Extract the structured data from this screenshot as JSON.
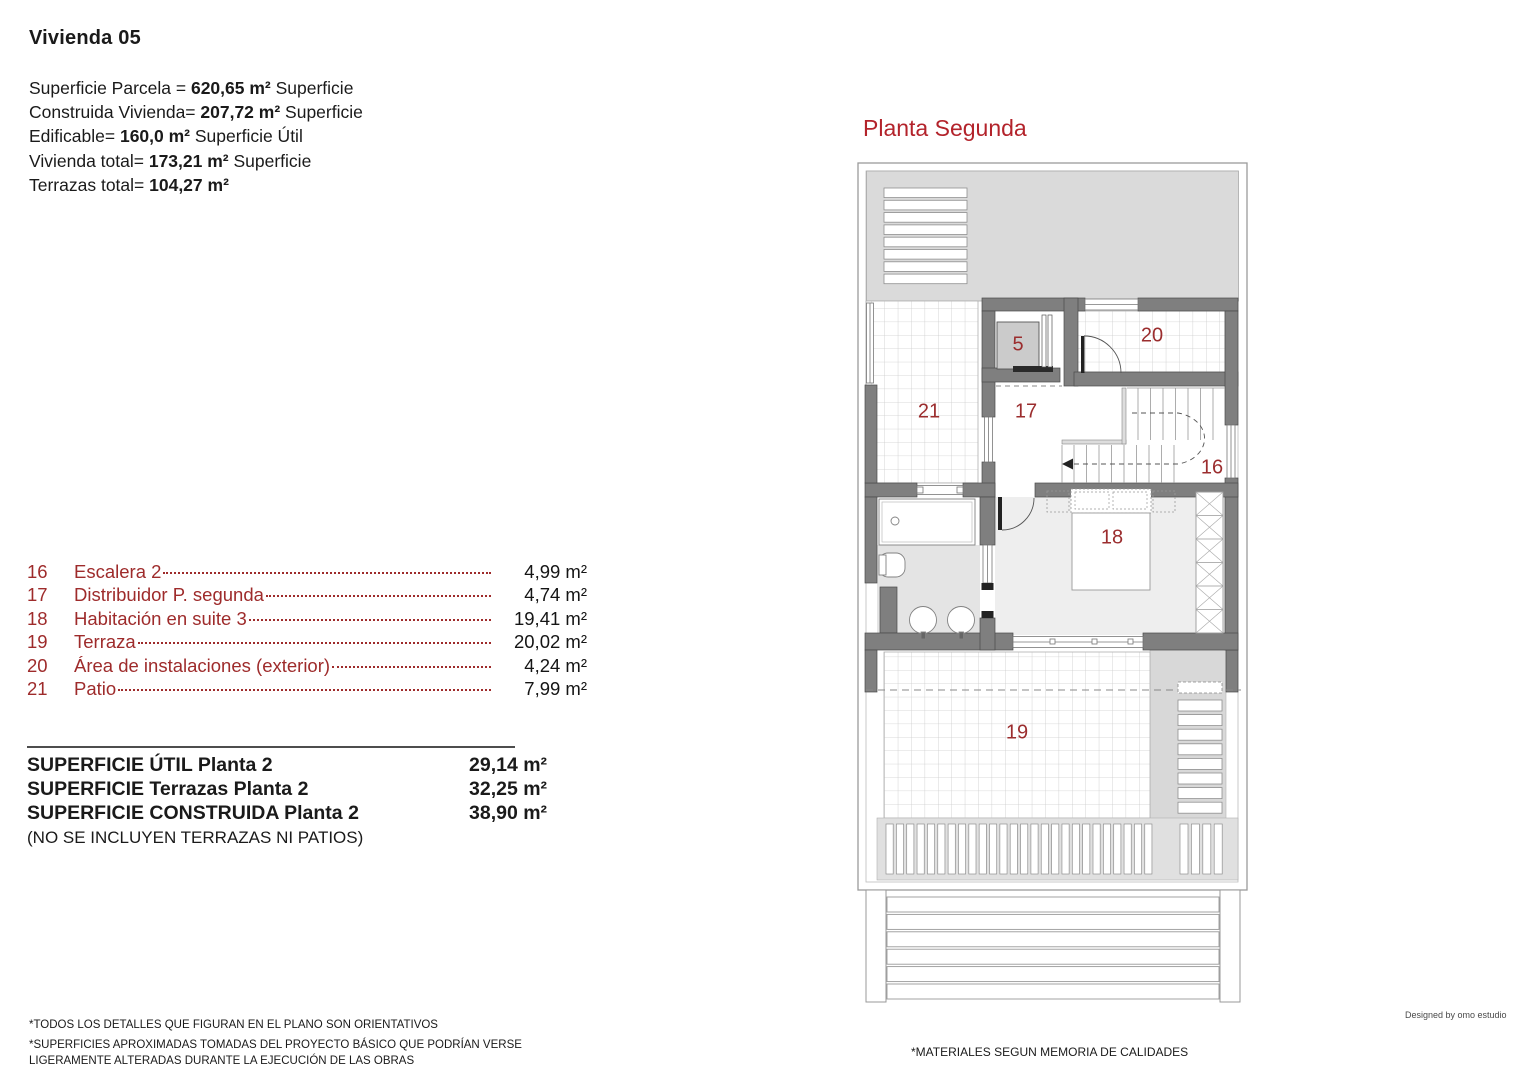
{
  "sheet": {
    "title": "Vivienda 05"
  },
  "top_specs": {
    "lines": [
      {
        "pre": "Superficie Parcela = ",
        "bold": "620,65 m²",
        "post": " Superficie"
      },
      {
        "pre": "Construida Vivienda= ",
        "bold": "207,72 m²",
        "post": " Superficie"
      },
      {
        "pre": "Edificable= ",
        "bold": "160,0 m²",
        "post": " Superficie Útil"
      },
      {
        "pre": "Vivienda total= ",
        "bold": "173,21 m²",
        "post": " Superficie"
      },
      {
        "pre": "Terrazas total= ",
        "bold": "104,27 m²",
        "post": ""
      }
    ]
  },
  "room_schedule": {
    "items": [
      {
        "num": "16",
        "name": "Escalera 2",
        "area": "4,99 m²"
      },
      {
        "num": "17",
        "name": "Distribuidor P. segunda",
        "area": "4,74 m²"
      },
      {
        "num": "18",
        "name": "Habitación en suite 3",
        "area": "19,41 m²"
      },
      {
        "num": "19",
        "name": "Terraza",
        "area": "20,02 m²"
      },
      {
        "num": "20",
        "name": "Área de instalaciones (exterior)",
        "area": "4,24 m²"
      },
      {
        "num": "21",
        "name": "Patio",
        "area": "7,99 m²"
      }
    ]
  },
  "area_summary": {
    "rows": [
      {
        "label": "SUPERFICIE ÚTIL Planta 2",
        "value": "29,14 m²"
      },
      {
        "label": "SUPERFICIE Terrazas Planta 2",
        "value": "32,25 m²"
      },
      {
        "label": "SUPERFICIE CONSTRUIDA Planta 2",
        "value": "38,90 m²"
      }
    ],
    "note": "(NO SE INCLUYEN TERRAZAS NI PATIOS)"
  },
  "plan": {
    "title": "Planta Segunda",
    "labels": {
      "r5": "5",
      "r16": "16",
      "r17": "17",
      "r18": "18",
      "r19": "19",
      "r20": "20",
      "r21": "21"
    }
  },
  "footer": {
    "disclaimer1": "*TODOS LOS DETALLES QUE FIGURAN EN EL PLANO SON ORIENTATIVOS",
    "disclaimer2": "*SUPERFICIES APROXIMADAS TOMADAS DEL PROYECTO BÁSICO QUE PODRÍAN VERSE LIGERAMENTE ALTERADAS DURANTE LA EJECUCIÓN DE LAS OBRAS",
    "materials": "*MATERIALES SEGUN MEMORIA DE CALIDADES",
    "credit": "Designed by omo estudio"
  },
  "colors": {
    "schedule_red": "#9e2b2b",
    "plan_title_red": "#b3232b",
    "plan_label_red": "#9b2d2e",
    "wall_gray": "#7f7f7f",
    "roof_gray": "#dadada"
  }
}
